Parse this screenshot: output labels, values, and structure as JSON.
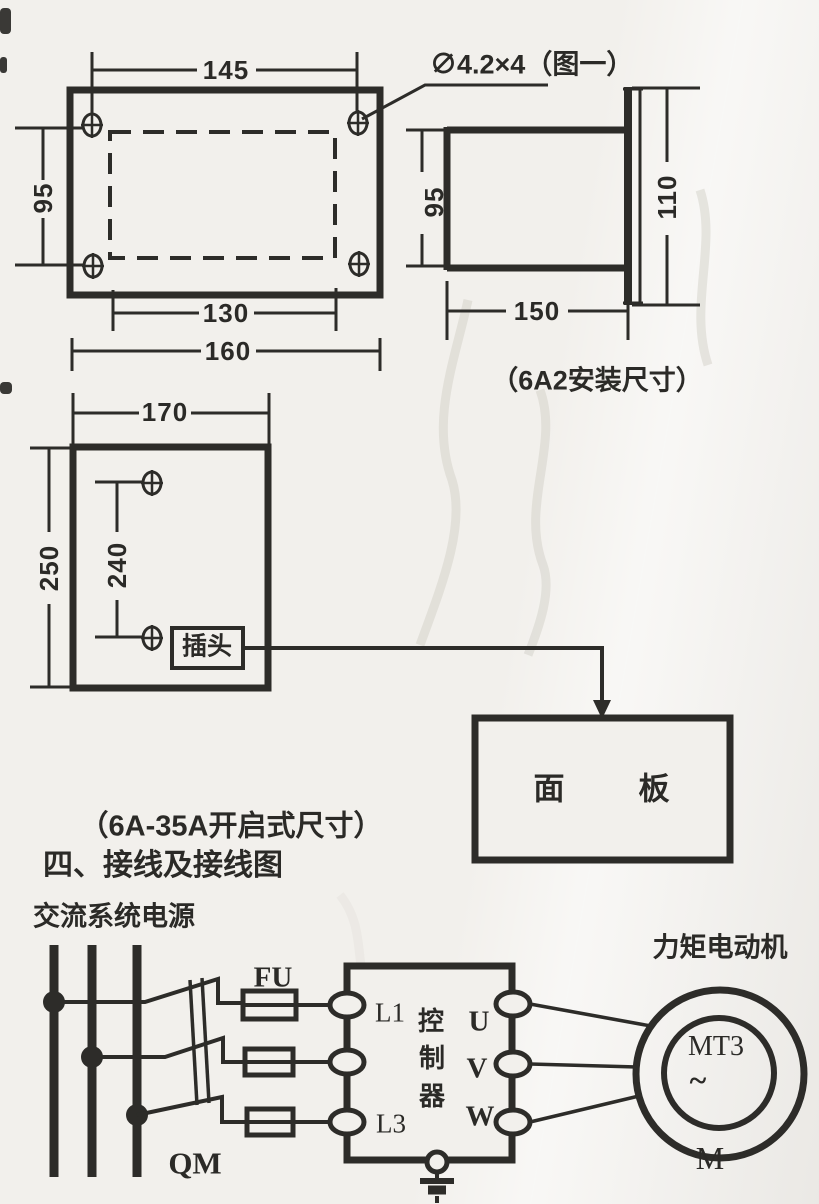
{
  "front_view": {
    "dim_hole_width": "145",
    "dim_hole_height": "95",
    "dim_inner_width": "130",
    "dim_outer_width": "160"
  },
  "annotation": {
    "hole_spec": "∅4.2×4（图一）"
  },
  "side_view": {
    "dim_body_height": "95",
    "dim_panel_height": "110",
    "dim_depth": "150",
    "caption": "（6A2安装尺寸）"
  },
  "open_view": {
    "dim_width": "170",
    "dim_height": "250",
    "dim_hole_spacing": "240",
    "plug_label": "插头",
    "panel_char_1": "面",
    "panel_char_2": "板",
    "caption": "（6A-35A开启式尺寸）"
  },
  "section": {
    "heading": "四、接线及接线图",
    "power_label": "交流系统电源"
  },
  "wiring": {
    "fuse_label": "FU",
    "switch_label": "QM",
    "terminal_l1": "L1",
    "terminal_l3": "L3",
    "controller_char_1": "控",
    "controller_char_2": "制",
    "controller_char_3": "器",
    "terminal_u": "U",
    "terminal_v": "V",
    "terminal_w": "W",
    "motor_label": "力矩电动机",
    "motor_model": "MT3",
    "motor_phase": "~",
    "motor_letter": "M"
  }
}
